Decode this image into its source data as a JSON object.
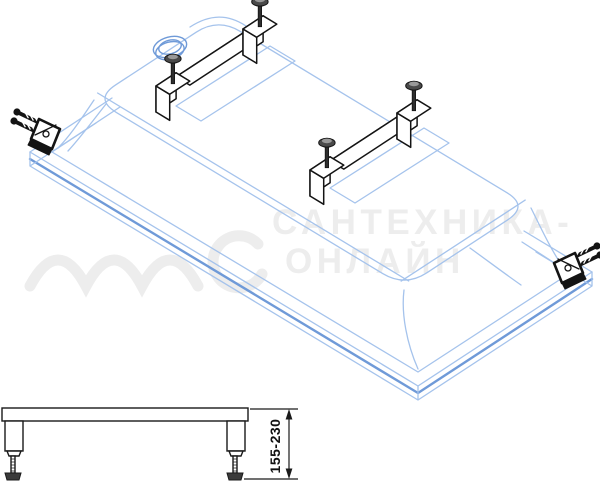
{
  "colors": {
    "background": "#ffffff",
    "tubline": "#a5c3ec",
    "tubstrong": "#6f9ad8",
    "ink": "#141414",
    "screwhead": "#4a4a4a",
    "screwtop": "#999999",
    "watermark": "#ededed"
  },
  "watermark": {
    "line1": "САНТЕХНИКА-",
    "line2": "ОНЛАЙН"
  },
  "main_drawing": {
    "parts": [
      "bathtub-shell-upside-down",
      "drain-hole",
      "mounting-rail-rear",
      "mounting-rail-front",
      "leveling-screws",
      "corner-bracket-left",
      "corner-bracket-right"
    ]
  },
  "side_view": {
    "dimension_label": "155-230"
  }
}
